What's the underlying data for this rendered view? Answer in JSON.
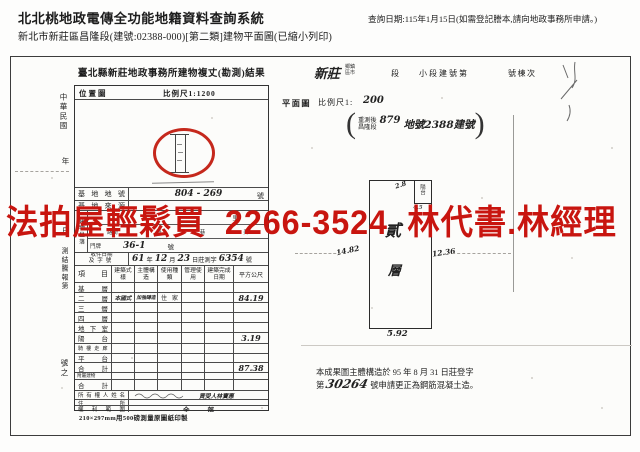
{
  "header": {
    "system_title": "北北桃地政電傳全功能地籍資料查詢系統",
    "query_date": "查詢日期:115年1月15日(如需登記謄本,請向地政事務所申請。)",
    "doc_line": "新北市新莊區昌隆段(建號:02388-000)[第二類]建物平面圖(已縮小列印)"
  },
  "banner": {
    "text": "法拍屋輕鬆買 2266-3524 林代書.林經理",
    "color": "#c8150f"
  },
  "form": {
    "title": "臺北縣新莊地政事務所建物複丈(勘測)結果",
    "margin": {
      "era": "中華民國",
      "year": "年",
      "day": "日",
      "report": "測結騰報第",
      "number": "號之"
    },
    "map": {
      "label": "位置圖",
      "scale": "比例尺1:1200"
    },
    "site": {
      "label": "基地地號",
      "value": "804 - 269",
      "unit": "號"
    },
    "source": {
      "label": "基地來源"
    },
    "address": {
      "label": "建物坐落",
      "li": "里",
      "road": "路街",
      "duan": "段",
      "lane": "巷",
      "alley": "弄",
      "gate": "門牌",
      "value": "36-1",
      "unit": "號"
    },
    "receipt": {
      "label1": "收件日期",
      "label2": "及字號",
      "y": "61",
      "y_l": "年",
      "m": "12",
      "m_l": "月",
      "d": "23",
      "d_l": "日莊測字",
      "no": "6354",
      "no_l": "號"
    },
    "table": {
      "col_item": "項目",
      "col_style": "建築式樣",
      "col_structure": "主體構造",
      "col_use": "使用種類",
      "col_manage": "管理使用",
      "col_done": "建築完成日期",
      "col_area": "平方公尺",
      "rows": [
        {
          "label": "基層"
        },
        {
          "label": "二層",
          "style": "本國式",
          "structure": "加強磚造",
          "use": "住家",
          "area": "84.19"
        },
        {
          "label": "三層"
        },
        {
          "label": "四層"
        },
        {
          "label": "地下室"
        },
        {
          "label": "陽台",
          "area": "3.19"
        },
        {
          "label": "騎樓走廊"
        },
        {
          "label": "平台"
        },
        {
          "label": "合計",
          "area": "87.38"
        },
        {
          "label": "附屬建物"
        },
        {
          "label": "合計"
        }
      ]
    },
    "owner": {
      "label": "所有權人姓名",
      "value": "買受人林寶惠"
    },
    "residence": {
      "label": "住所"
    },
    "rights": {
      "label": "權利範圍",
      "value": "全部"
    },
    "footnote": "210×297mm用500磅測量原圖紙印製"
  },
  "plan": {
    "township_value": "新莊",
    "township_unit1": "鄉鎮",
    "township_unit2": "區市",
    "duan": "段",
    "subsection": "小段建號第",
    "building_no": "號棟次",
    "label": "平面圖",
    "scale_label": "比例尺1:",
    "scale_value": "200",
    "note_line1": "重測後",
    "note_line2": "昌隆段",
    "note_no": "879",
    "note_rest": "地號2388建號",
    "floor_char1": "貳",
    "floor_char2": "層",
    "balcony": "陽台",
    "dim_top": "2.8",
    "dim_small": "4.5",
    "dim_left": "14.82",
    "dim_right": "12.36",
    "dim_bottom": "5.92",
    "remark_line1": "本成果圖主體構造於 95 年 8 月 31 日莊登字",
    "remark_pre": "第",
    "remark_no": "30264",
    "remark_post": "號申請更正為鋼筋混凝土造。"
  }
}
